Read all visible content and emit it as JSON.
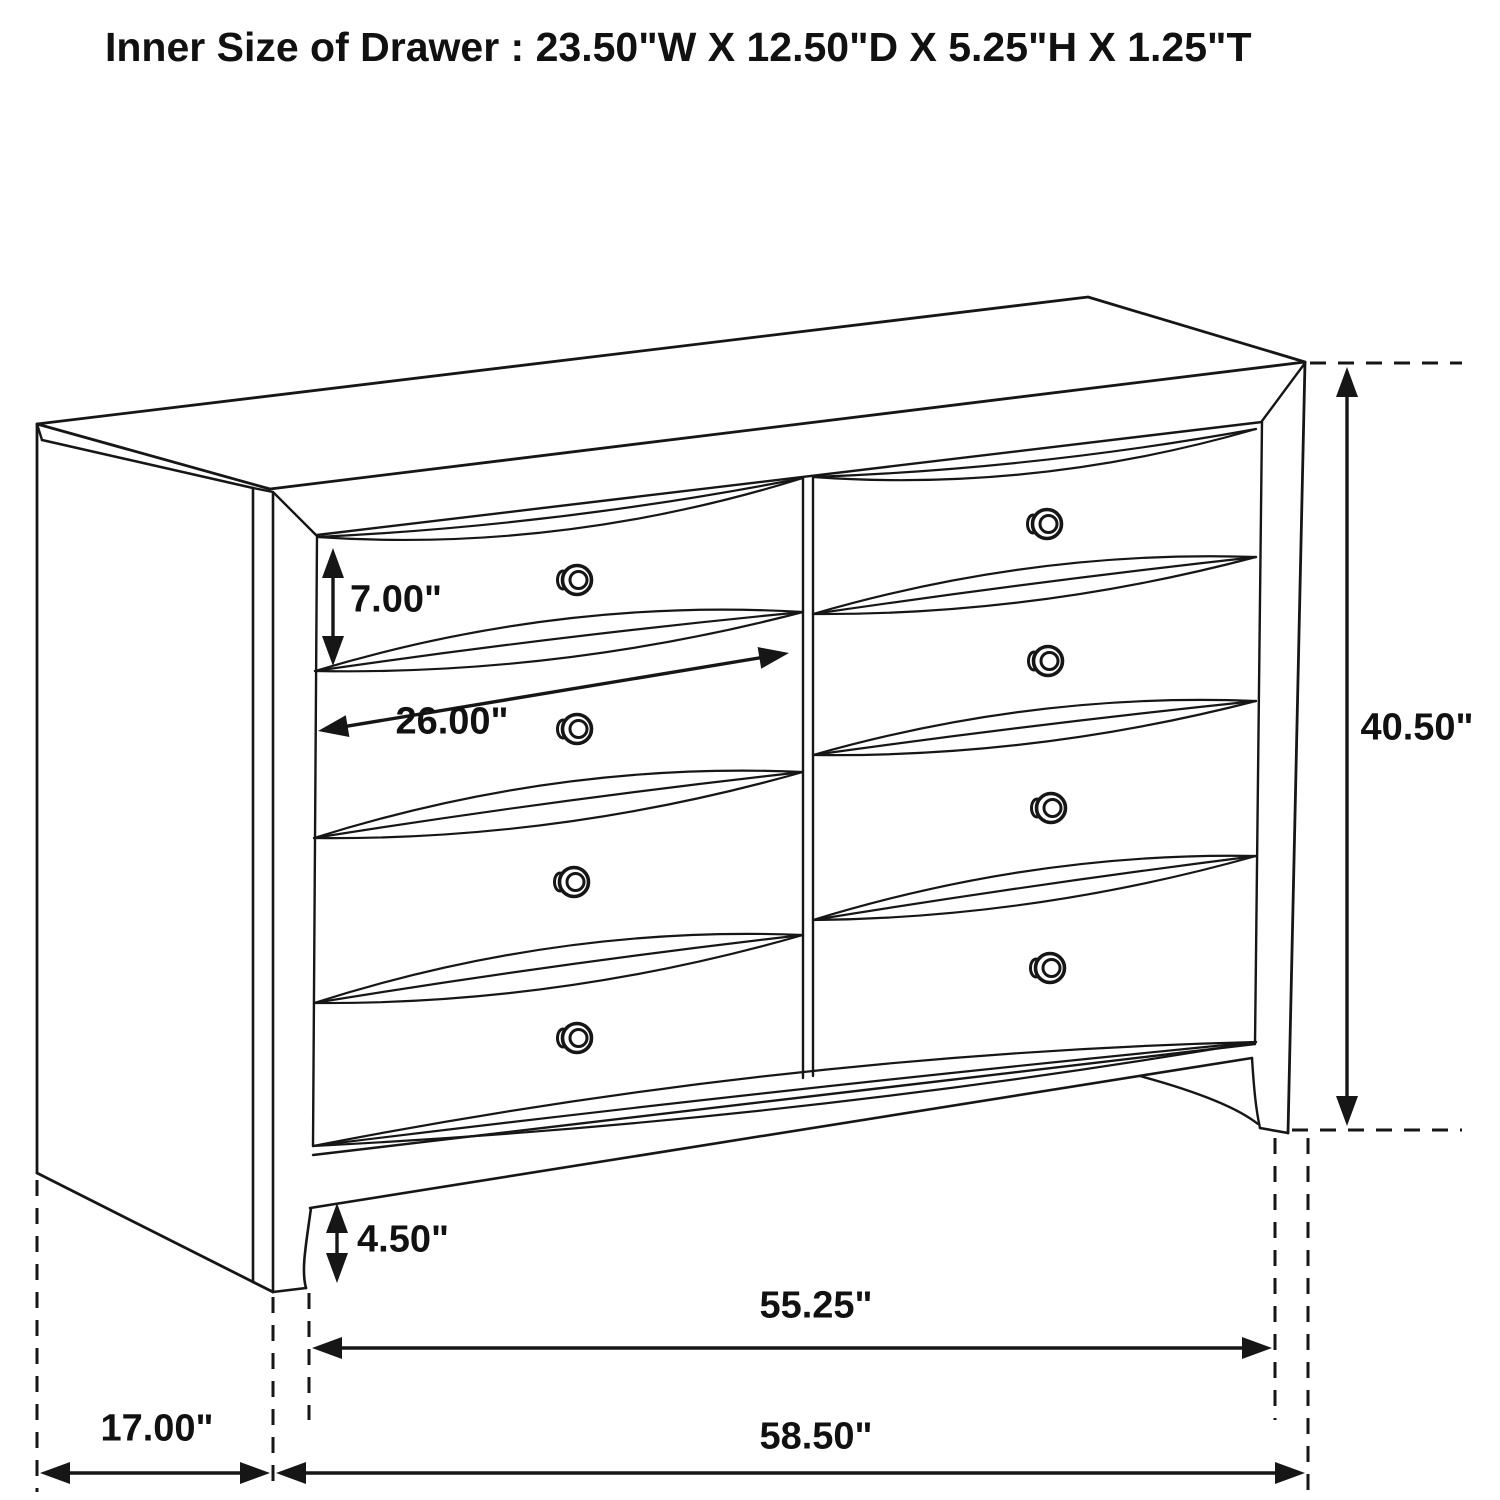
{
  "page": {
    "background": "#ffffff",
    "ink": "#161616"
  },
  "title": "Inner Size of Drawer : 23.50\"W X 12.50\"D X 5.25\"H X 1.25\"T",
  "diagram": {
    "type": "furniture-dimension-line-drawing",
    "subject": "dresser",
    "drawers": {
      "columns": 2,
      "rows": 4,
      "knob_count": 8,
      "knob_style": "round"
    },
    "inner_drawer_size": {
      "width_label": "23.50\"W",
      "depth_label": "12.50\"D",
      "height_label": "5.25\"H",
      "thickness_label": "1.25\"T"
    },
    "dimensions": [
      {
        "id": "drawer_height",
        "label": "7.00\"",
        "value_in": 7.0,
        "orientation": "vertical"
      },
      {
        "id": "drawer_width",
        "label": "26.00\"",
        "value_in": 26.0,
        "orientation": "diagonal"
      },
      {
        "id": "overall_height",
        "label": "40.50\"",
        "value_in": 40.5,
        "orientation": "vertical"
      },
      {
        "id": "leg_height",
        "label": "4.50\"",
        "value_in": 4.5,
        "orientation": "vertical"
      },
      {
        "id": "inner_width",
        "label": "55.25\"",
        "value_in": 55.25,
        "orientation": "horizontal"
      },
      {
        "id": "overall_width",
        "label": "58.50\"",
        "value_in": 58.5,
        "orientation": "horizontal"
      },
      {
        "id": "side_depth",
        "label": "17.00\"",
        "value_in": 17.0,
        "orientation": "horizontal"
      }
    ]
  }
}
